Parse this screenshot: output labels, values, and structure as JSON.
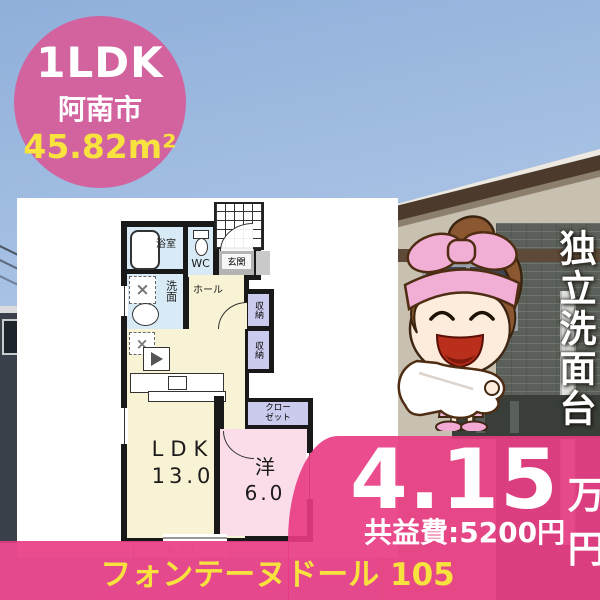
{
  "badge": {
    "layout": "1LDK",
    "city": "阿南市",
    "area_value": "45.82",
    "area_unit": "m²"
  },
  "floorplan": {
    "bath": "浴室",
    "wc": "WC",
    "entrance": "玄関",
    "washroom": "洗面",
    "hall": "ホール",
    "storage_upper": "収納",
    "storage_lower": "収納",
    "closet_line1": "クロー",
    "closet_line2": "ゼット",
    "ldk_label": "LDK",
    "ldk_size": "13.0",
    "western_label": "洋",
    "western_size": "6.0",
    "terrace": "テラス"
  },
  "side_caption": "独立洗面台",
  "price": {
    "rent_value": "4.15",
    "rent_unit": "万円",
    "common_fee": "共益費:5200円"
  },
  "property_name": "フォンテーヌドール 105",
  "icons": {
    "washing_machine": "×",
    "refrigerator": "×"
  },
  "colors": {
    "badge_pink": "#d2639f",
    "overlay_pink": "#e83a83",
    "highlight_yellow": "#f8e23e",
    "plan_cream": "#f8f3d4",
    "plan_blue": "#d7eaf6",
    "plan_purple": "#cbcbee",
    "plan_pink_room": "#fbdde9"
  }
}
